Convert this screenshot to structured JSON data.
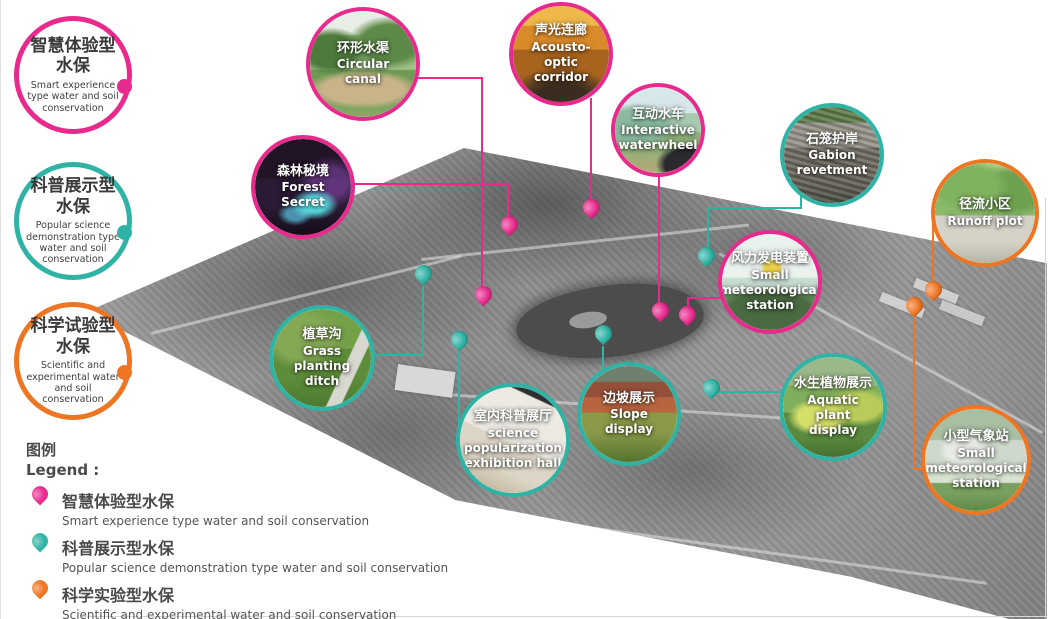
{
  "colors": {
    "smart": "#e82a8d",
    "demo": "#2eb3a4",
    "exp": "#ee7522"
  },
  "badges": [
    {
      "zh1": "智慧体验型",
      "zh2": "水保",
      "en": "Smart experience type water and soil conservation",
      "type": "smart"
    },
    {
      "zh1": "科普展示型",
      "zh2": "水保",
      "en": "Popular science demonstration type water and soil conservation",
      "type": "demo"
    },
    {
      "zh1": "科学试验型",
      "zh2": "水保",
      "en": "Scientific and experimental water and soil conservation",
      "type": "exp"
    }
  ],
  "legend": {
    "title_zh": "图例",
    "title_en": "Legend :",
    "items": [
      {
        "zh": "智慧体验型水保",
        "en": "Smart experience type water and soil conservation",
        "type": "smart"
      },
      {
        "zh": "科普展示型水保",
        "en": "Popular science demonstration type water and soil conservation",
        "type": "demo"
      },
      {
        "zh": "科学实验型水保",
        "en": "Scientific and experimental water and soil conservation",
        "type": "exp"
      }
    ]
  },
  "callouts": [
    {
      "zh": "环形水渠",
      "en": "Circular canal",
      "type": "smart",
      "photo": "canal",
      "cx": 362,
      "cy": 64,
      "r": 57
    },
    {
      "zh": "声光连廊",
      "en": "Acousto-optic corridor",
      "type": "smart",
      "photo": "corridor",
      "cx": 560,
      "cy": 54,
      "r": 52
    },
    {
      "zh": "互动水车",
      "en": "Interactive waterwheel",
      "type": "smart",
      "photo": "waterwheel",
      "cx": 657,
      "cy": 130,
      "r": 47
    },
    {
      "zh": "石笼护岸",
      "en": "Gabion revetment",
      "type": "demo",
      "photo": "gabion",
      "cx": 831,
      "cy": 155,
      "r": 52
    },
    {
      "zh": "森林秘境",
      "en": "Forest Secret",
      "type": "smart",
      "photo": "forest",
      "cx": 302,
      "cy": 187,
      "r": 52
    },
    {
      "zh": "径流小区",
      "en": "Runoff plot",
      "type": "exp",
      "photo": "runoff",
      "cx": 984,
      "cy": 213,
      "r": 54
    },
    {
      "zh": "风力发电装置",
      "en": "Small meteorological station",
      "type": "smart",
      "photo": "wind",
      "cx": 769,
      "cy": 282,
      "r": 52
    },
    {
      "zh": "植草沟",
      "en": "Grass planting ditch",
      "type": "demo",
      "photo": "grass",
      "cx": 321,
      "cy": 358,
      "r": 53
    },
    {
      "zh": "室内科普展厅",
      "en": "science popularization exhibition hall",
      "type": "demo",
      "photo": "hall",
      "cx": 512,
      "cy": 440,
      "r": 57
    },
    {
      "zh": "边坡展示",
      "en": "Slope display",
      "type": "demo",
      "photo": "slope",
      "cx": 628,
      "cy": 414,
      "r": 52
    },
    {
      "zh": "水生植物展示",
      "en": "Aquatic plant display",
      "type": "demo",
      "photo": "aquatic",
      "cx": 832,
      "cy": 407,
      "r": 54
    },
    {
      "zh": "小型气象站",
      "en": "Small meteorological station",
      "type": "exp",
      "photo": "station",
      "cx": 975,
      "cy": 460,
      "r": 55
    }
  ],
  "map": {
    "pins": [
      {
        "x": 482,
        "y": 294,
        "type": "smart"
      },
      {
        "x": 508,
        "y": 224,
        "type": "smart"
      },
      {
        "x": 590,
        "y": 207,
        "type": "smart"
      },
      {
        "x": 659,
        "y": 310,
        "type": "smart"
      },
      {
        "x": 686,
        "y": 314,
        "type": "smart"
      },
      {
        "x": 422,
        "y": 273,
        "type": "demo"
      },
      {
        "x": 458,
        "y": 339,
        "type": "demo"
      },
      {
        "x": 602,
        "y": 333,
        "type": "demo"
      },
      {
        "x": 710,
        "y": 387,
        "type": "demo"
      },
      {
        "x": 705,
        "y": 255,
        "type": "demo"
      },
      {
        "x": 932,
        "y": 289,
        "type": "exp"
      },
      {
        "x": 913,
        "y": 305,
        "type": "exp"
      }
    ],
    "lines": [
      {
        "x": 416,
        "y": 77,
        "w": 66,
        "h": 2,
        "type": "smart"
      },
      {
        "x": 480,
        "y": 77,
        "w": 2,
        "h": 218,
        "type": "smart"
      },
      {
        "x": 353,
        "y": 183,
        "w": 154,
        "h": 2,
        "type": "smart"
      },
      {
        "x": 506,
        "y": 183,
        "w": 2,
        "h": 36,
        "type": "smart"
      },
      {
        "x": 589,
        "y": 98,
        "w": 2,
        "h": 110,
        "type": "smart"
      },
      {
        "x": 657,
        "y": 176,
        "w": 2,
        "h": 136,
        "type": "smart"
      },
      {
        "x": 686,
        "y": 297,
        "w": 36,
        "h": 2,
        "type": "smart"
      },
      {
        "x": 686,
        "y": 297,
        "w": 2,
        "h": 18,
        "type": "smart"
      },
      {
        "x": 707,
        "y": 207,
        "w": 94,
        "h": 2,
        "type": "demo"
      },
      {
        "x": 799,
        "y": 195,
        "w": 2,
        "h": 14,
        "type": "demo"
      },
      {
        "x": 706,
        "y": 207,
        "w": 2,
        "h": 50,
        "type": "demo"
      },
      {
        "x": 421,
        "y": 286,
        "w": 2,
        "h": 70,
        "type": "demo"
      },
      {
        "x": 372,
        "y": 354,
        "w": 50,
        "h": 2,
        "type": "demo"
      },
      {
        "x": 457,
        "y": 352,
        "w": 2,
        "h": 73,
        "type": "demo"
      },
      {
        "x": 601,
        "y": 346,
        "w": 2,
        "h": 27,
        "type": "demo"
      },
      {
        "x": 711,
        "y": 391,
        "w": 72,
        "h": 2,
        "type": "demo"
      },
      {
        "x": 931,
        "y": 214,
        "w": 2,
        "h": 77,
        "type": "exp"
      },
      {
        "x": 912,
        "y": 318,
        "w": 2,
        "h": 152,
        "type": "exp"
      },
      {
        "x": 912,
        "y": 468,
        "w": 14,
        "h": 2,
        "type": "exp"
      }
    ]
  }
}
